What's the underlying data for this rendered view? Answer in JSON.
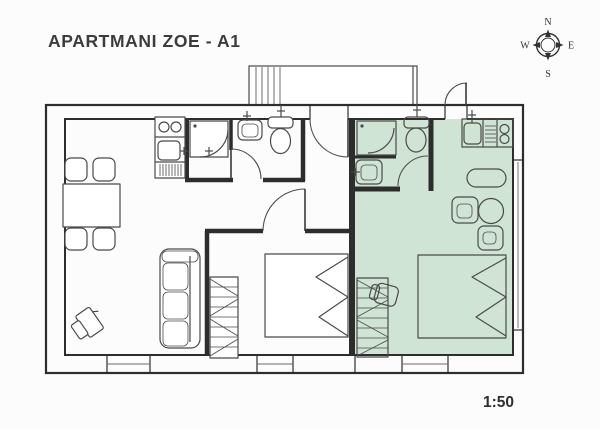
{
  "title": "APARTMANI ZOE - A1",
  "scale_label": "1:50",
  "compass": {
    "north": "N",
    "east": "E",
    "south": "S",
    "west": "W"
  },
  "colors": {
    "highlight": "#cfe4d4",
    "wall": "#2d2d2d",
    "line": "#4a4a4a",
    "text": "#3c3c3c"
  }
}
